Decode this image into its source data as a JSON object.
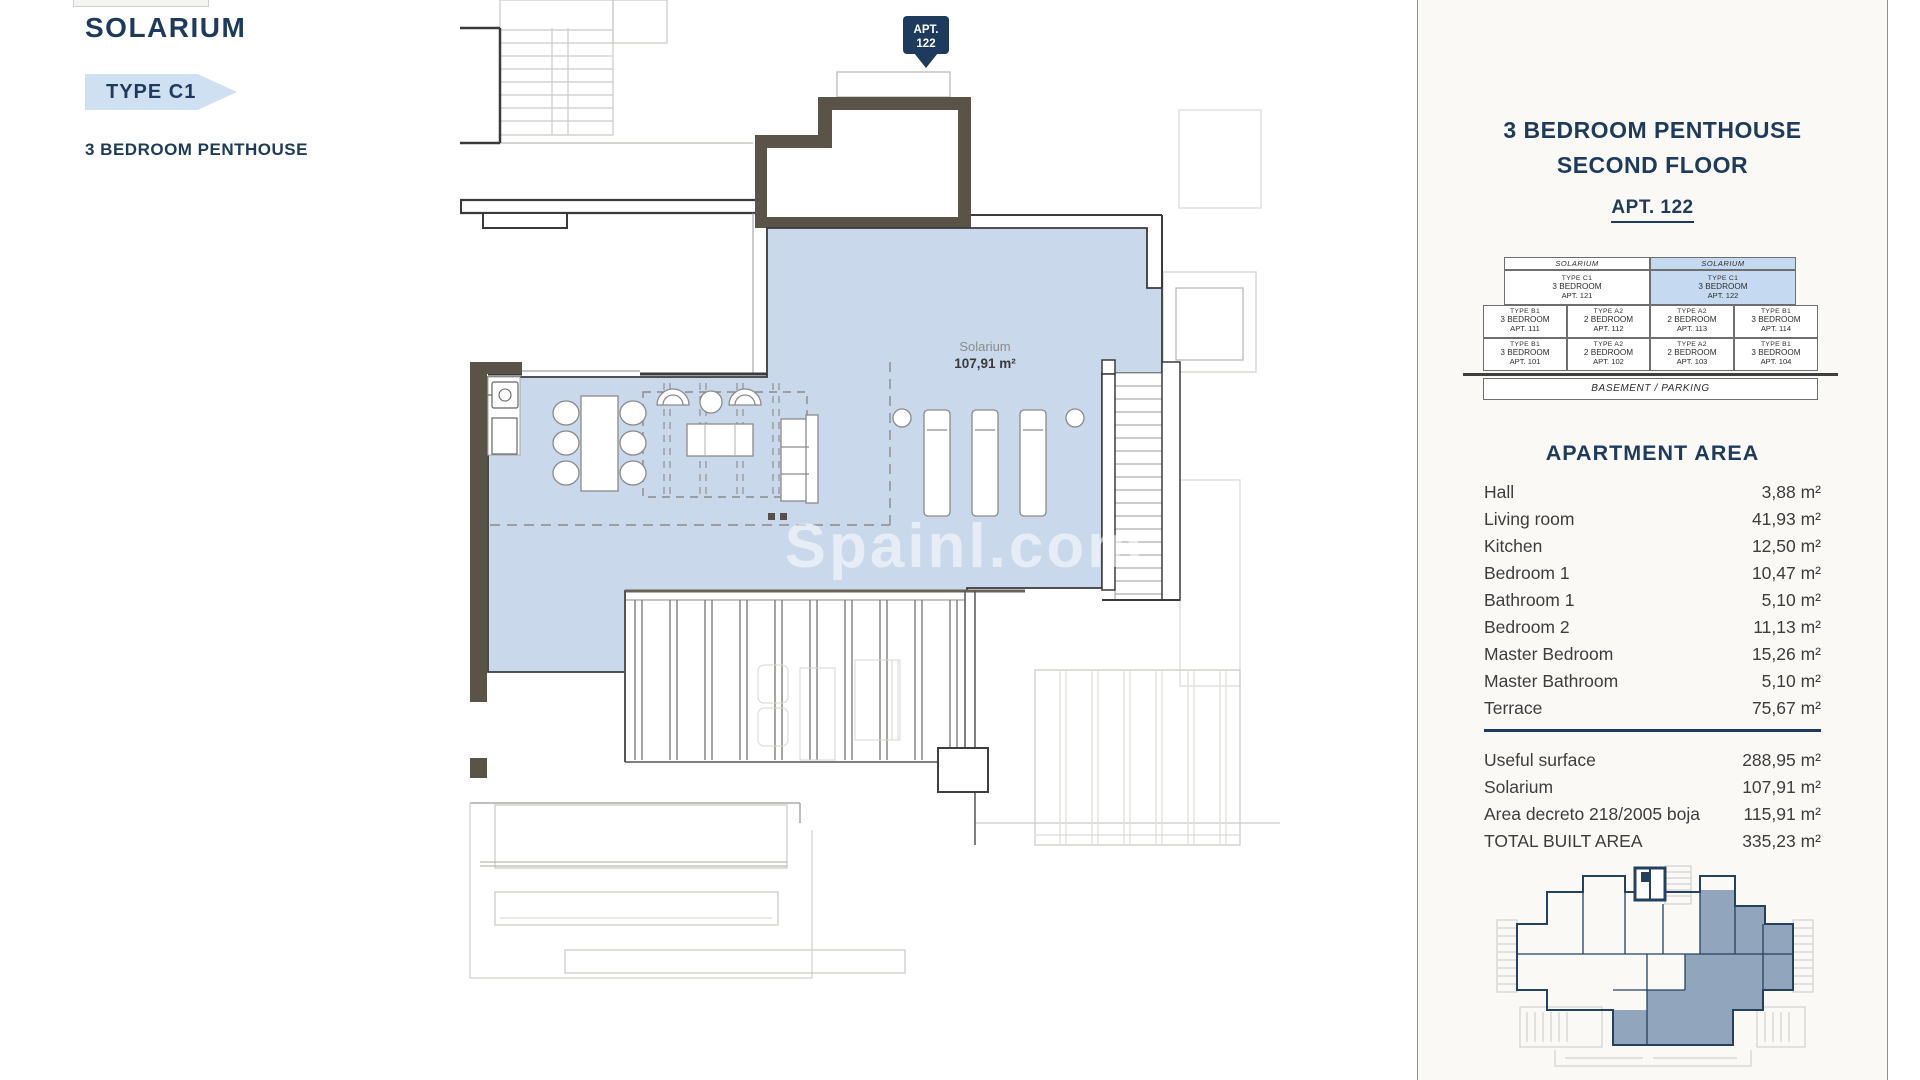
{
  "header": {
    "title": "SOLARIUM",
    "type_badge": "TYPE C1",
    "subtitle": "3 BEDROOM PENTHOUSE"
  },
  "plan": {
    "apt_flag_line1": "APT.",
    "apt_flag_line2": "122",
    "room_name": "Solarium",
    "room_area": "107,91 m²",
    "watermark": "Spainl.com"
  },
  "panel": {
    "title_line1": "3 BEDROOM PENTHOUSE",
    "title_line2": "SECOND FLOOR",
    "apt_label": "APT. 122",
    "stack": {
      "solarium_left": "SOLARIUM",
      "solarium_right": "SOLARIUM",
      "penthouses": [
        {
          "type": "TYPE C1",
          "bedrooms": "3 BEDROOM",
          "apt": "APT. 121"
        },
        {
          "type": "TYPE C1",
          "bedrooms": "3 BEDROOM",
          "apt": "APT. 122"
        }
      ],
      "floors": [
        [
          {
            "type": "TYPE B1",
            "bedrooms": "3 BEDROOM",
            "apt": "APT. 111"
          },
          {
            "type": "TYPE A2",
            "bedrooms": "2 BEDROOM",
            "apt": "APT. 112"
          },
          {
            "type": "TYPE A2",
            "bedrooms": "2 BEDROOM",
            "apt": "APT. 113"
          },
          {
            "type": "TYPE B1",
            "bedrooms": "3 BEDROOM",
            "apt": "APT. 114"
          }
        ],
        [
          {
            "type": "TYPE B1",
            "bedrooms": "3 BEDROOM",
            "apt": "APT. 101"
          },
          {
            "type": "TYPE A2",
            "bedrooms": "2 BEDROOM",
            "apt": "APT. 102"
          },
          {
            "type": "TYPE A2",
            "bedrooms": "2 BEDROOM",
            "apt": "APT. 103"
          },
          {
            "type": "TYPE B1",
            "bedrooms": "3 BEDROOM",
            "apt": "APT. 104"
          }
        ]
      ],
      "basement": "BASEMENT / PARKING"
    },
    "area_title": "APARTMENT AREA",
    "rooms": [
      {
        "label": "Hall",
        "value": "3,88 m²"
      },
      {
        "label": "Living room",
        "value": "41,93 m²"
      },
      {
        "label": "Kitchen",
        "value": "12,50 m²"
      },
      {
        "label": "Bedroom 1",
        "value": "10,47 m²"
      },
      {
        "label": "Bathroom 1",
        "value": "5,10 m²"
      },
      {
        "label": "Bedroom 2",
        "value": "11,13 m²"
      },
      {
        "label": "Master Bedroom",
        "value": "15,26 m²"
      },
      {
        "label": "Master Bathroom",
        "value": "5,10 m²"
      },
      {
        "label": "Terrace",
        "value": "75,67 m²"
      }
    ],
    "totals": [
      {
        "label": "Useful surface",
        "value": "288,95 m²"
      },
      {
        "label": "Solarium",
        "value": "107,91 m²"
      },
      {
        "label": "Area decreto 218/2005 boja",
        "value": "115,91 m²"
      },
      {
        "label": "TOTAL BUILT AREA",
        "value": "335,23 m²"
      }
    ]
  },
  "colors": {
    "navy": "#1e3a5c",
    "badge_blue": "#cfe0f2",
    "highlight_blue": "#c5daf0",
    "solarium_fill": "#c9d8ea",
    "wall_brown": "#5a5348",
    "panel_bg": "#faf9f6"
  }
}
